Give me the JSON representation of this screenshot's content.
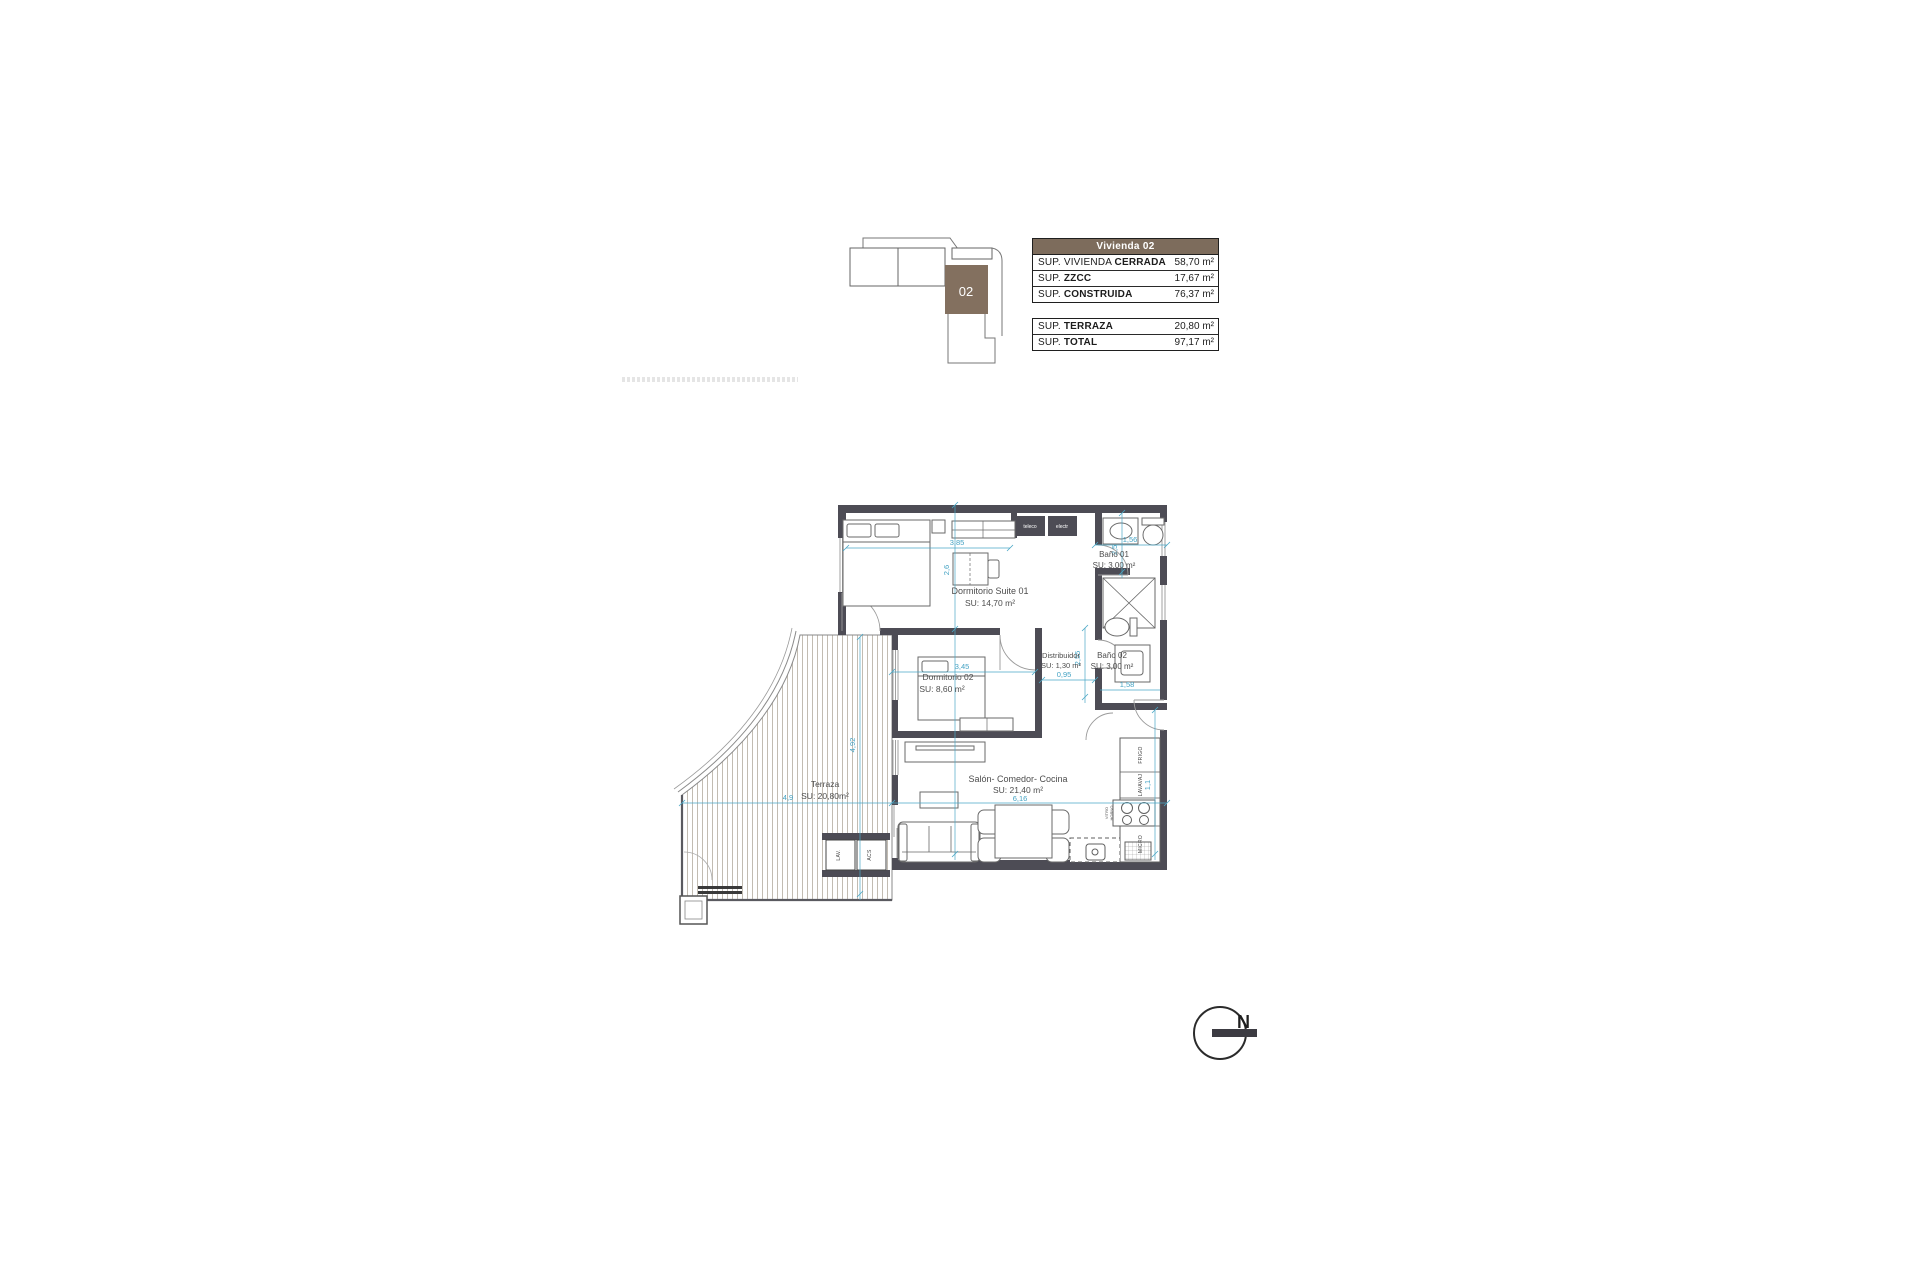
{
  "key_plan": {
    "unit": "02"
  },
  "tables": {
    "header": "Vivienda 02",
    "main_rows": [
      {
        "prefix": "SUP. VIVIENDA ",
        "bold": "CERRADA",
        "value": "58,70 m²"
      },
      {
        "prefix": "SUP. ",
        "bold": "ZZCC",
        "value": "17,67 m²"
      },
      {
        "prefix": "SUP. ",
        "bold": "CONSTRUIDA",
        "value": "76,37 m²"
      }
    ],
    "total_rows": [
      {
        "prefix": "SUP. ",
        "bold": "TERRAZA",
        "value": "20,80 m²"
      },
      {
        "prefix": "SUP. ",
        "bold": "TOTAL",
        "value": "97,17 m²"
      }
    ]
  },
  "plan": {
    "rooms": {
      "suite": {
        "name": "Dormitorio Suite 01",
        "area": "SU: 14,70 m²"
      },
      "bano1": {
        "name": "Baño 01",
        "area": "SU: 3,00 m²"
      },
      "distribuidor": {
        "name": "Distribuidor",
        "area": "SU: 1,30 m²"
      },
      "bano2": {
        "name": "Baño 02",
        "area": "SU: 3,00 m²"
      },
      "dorm2": {
        "name": "Dormitorio 02",
        "area": "SU: 8,60 m²"
      },
      "salon": {
        "name": "Salón- Comedor- Cocina",
        "area": "SU: 21,40 m²"
      },
      "terraza": {
        "name": "Terraza",
        "area": "SU: 20,80m²"
      }
    },
    "dims": {
      "suite_w": "3,85",
      "suite_h": "2,6",
      "bano1_w": "1,56",
      "bano1_h": "2,5",
      "hall_h": "2,55",
      "distrib_w": "0,95",
      "dorm2_w": "3,45",
      "bano2_w": "1,58",
      "entry_h": "1,1",
      "salon_w": "6,16",
      "terraza_w": "4,9",
      "terraza_h": "4,92"
    },
    "labels": {
      "teleco": "teleco",
      "electr": "electr",
      "frigo": "FRIGO",
      "lavavaj": "LAVAVAJ",
      "vitro": "VITRO",
      "horno": "HORNO",
      "micro": "MICRO",
      "lav": "LAV.",
      "acs": "ACS"
    }
  },
  "north": {
    "label": "N"
  },
  "colors": {
    "accent_brown": "#83705F",
    "wall": "#4D4C55",
    "dimension": "#4AA7C6"
  }
}
